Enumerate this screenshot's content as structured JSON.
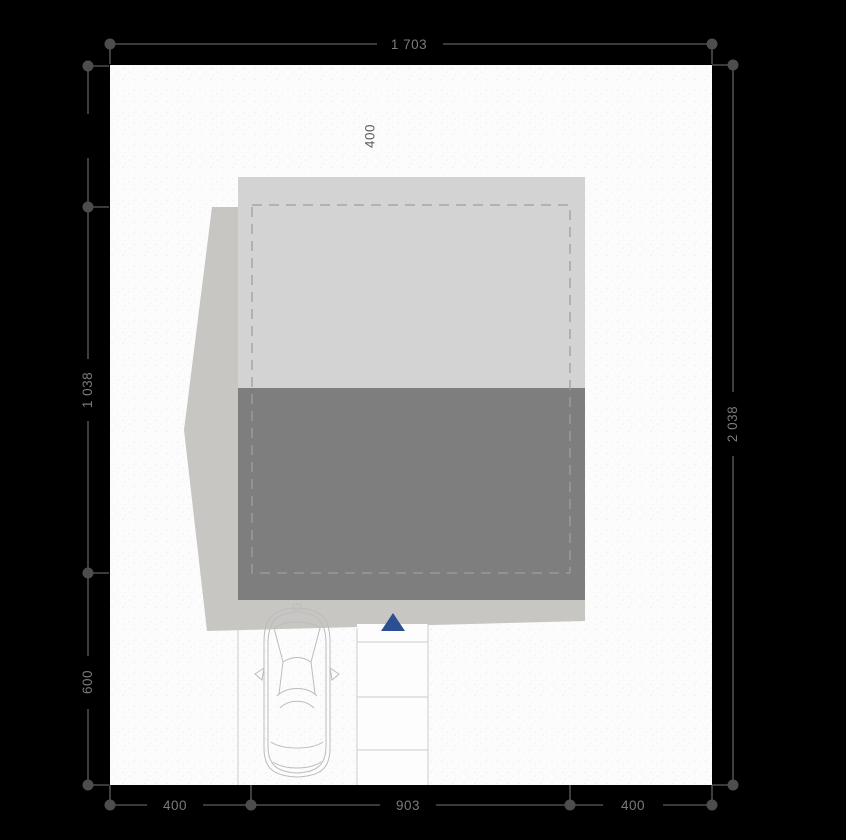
{
  "plan": {
    "type": "architectural-site-plan",
    "dimensions": {
      "plot_width_top": "1 703",
      "building_depth_left": "1 038",
      "front_strip_left": "600",
      "plot_depth_right": "2 038",
      "setback_left_bottom": "400",
      "building_width_bottom": "903",
      "setback_right_bottom": "400",
      "setback_top": "400"
    },
    "icons": {
      "entrance_arrow": "triangle-up",
      "car": "car-top-view"
    },
    "colors": {
      "background": "#000000",
      "plot_fill": "#fcfcfc",
      "plot_dot_texture": "#ebebeb",
      "roof_fill": "#d3d3d3",
      "building_fill": "#7e7e7e",
      "shadow_fill": "#c7c6c3",
      "dashed_wall": "#9f9f9f",
      "walkway_line": "#cbcbcb",
      "car_outline": "#bcbcbc",
      "dimension_line": "#4d4d4d",
      "dimension_text": "#7a7a7a",
      "entrance_arrow": "#2b4f90"
    }
  }
}
